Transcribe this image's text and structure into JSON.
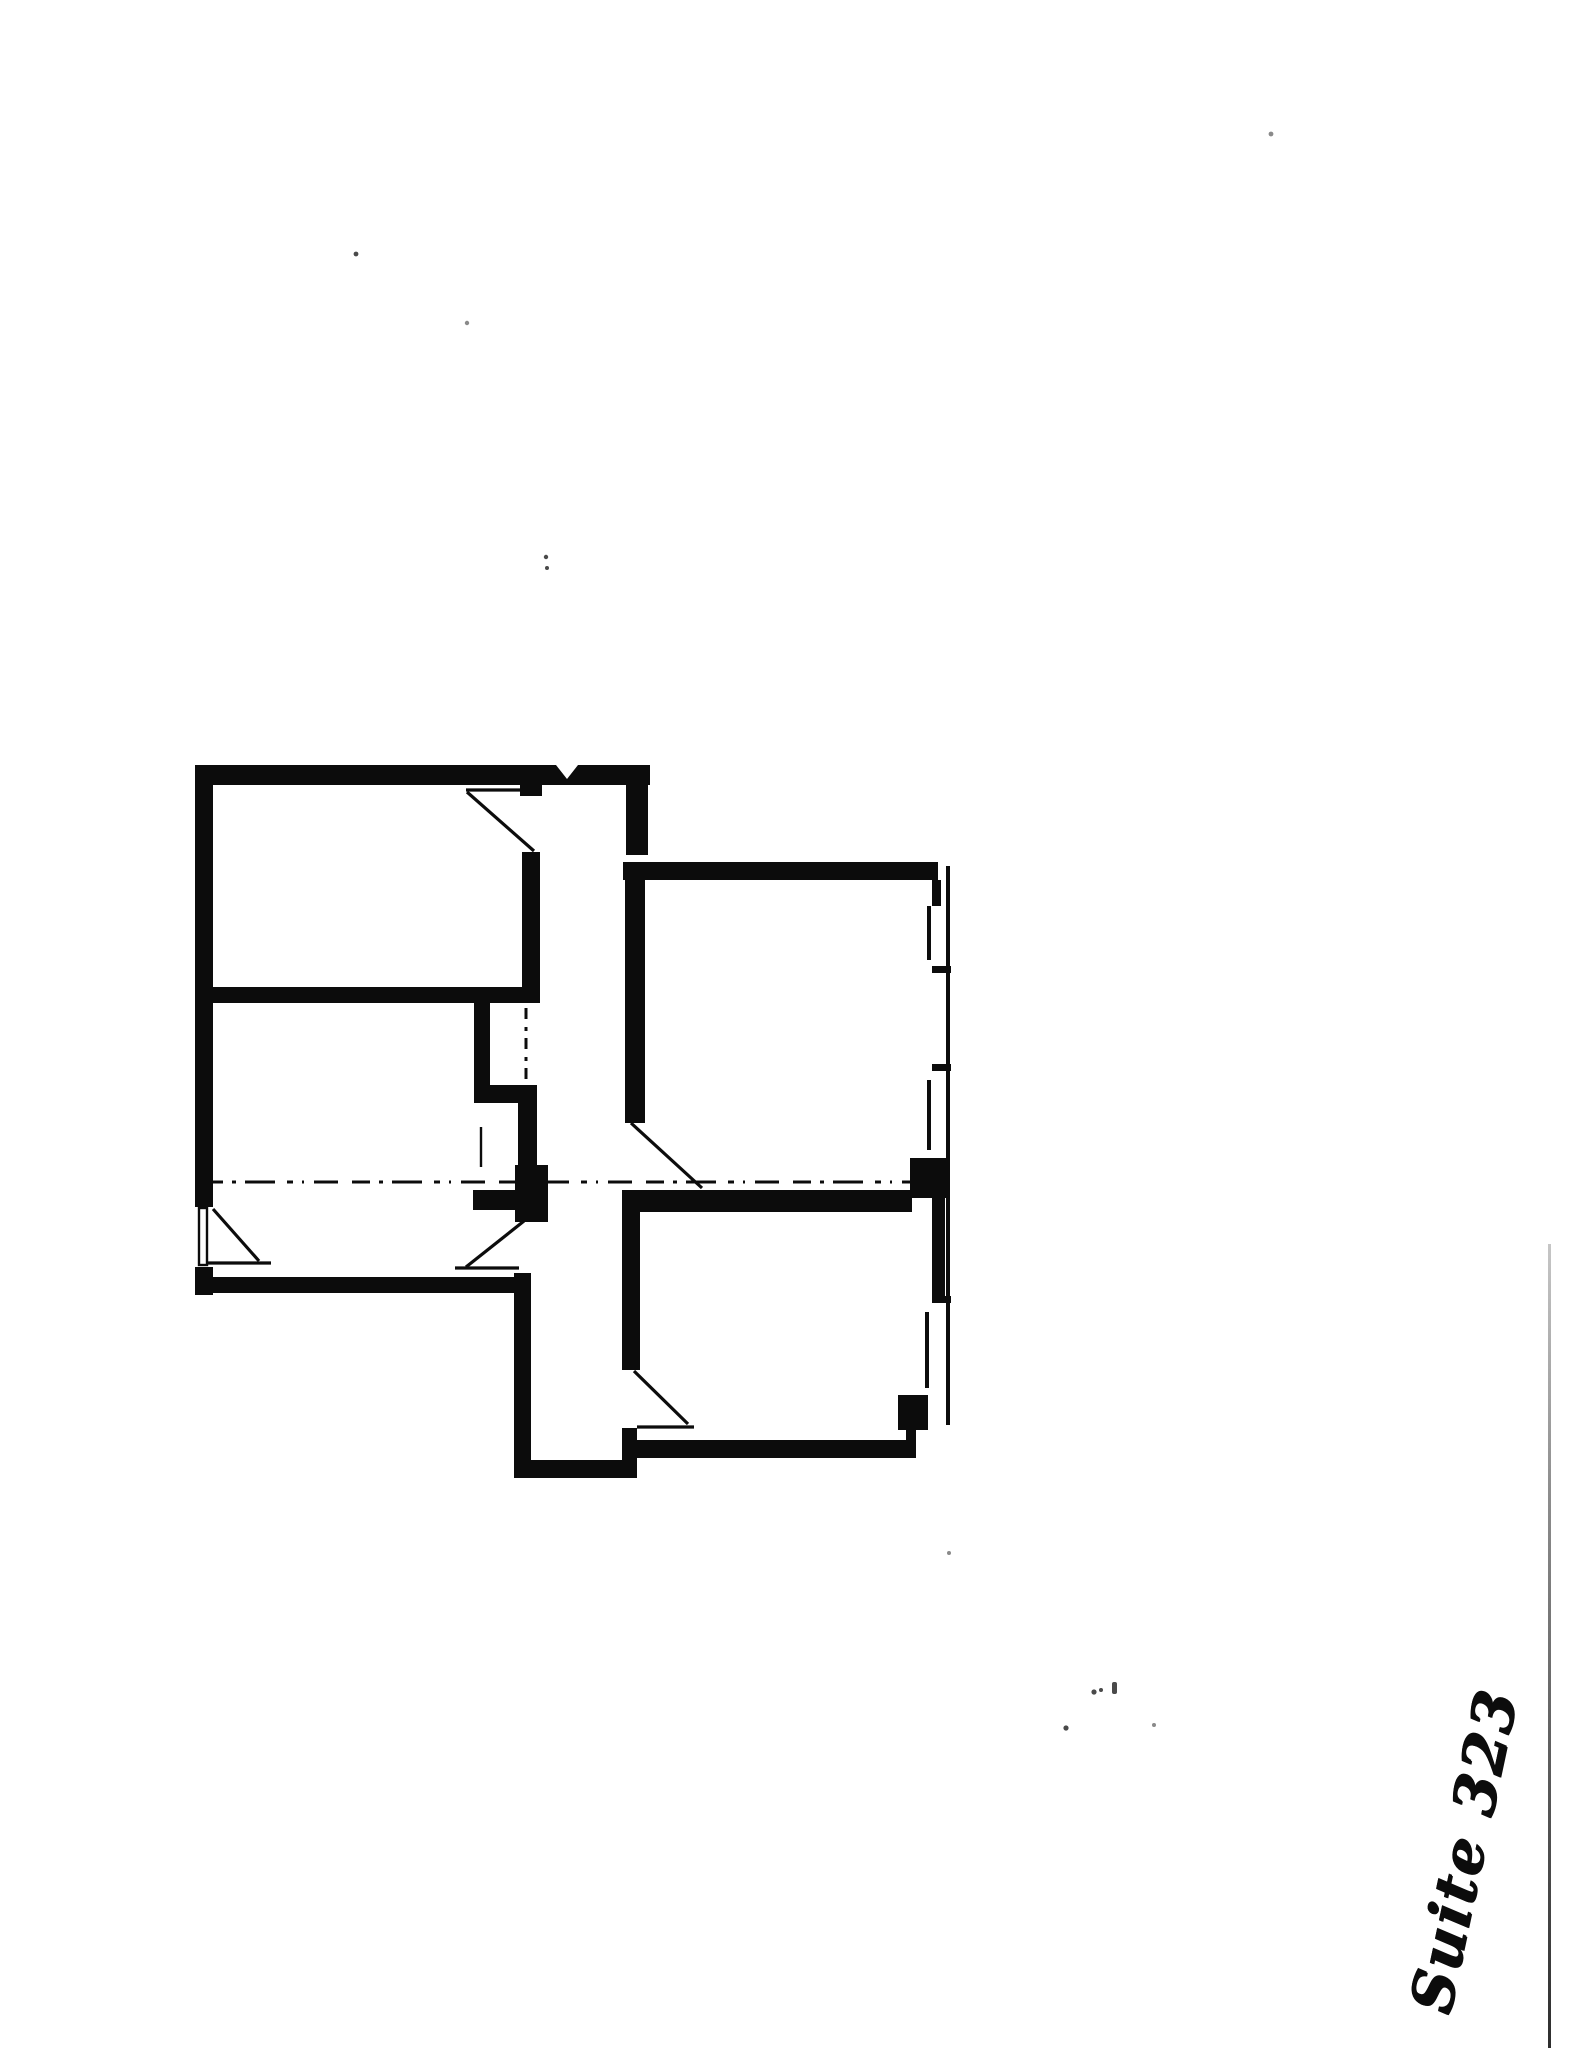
{
  "page": {
    "suite_label": "Suite 323"
  },
  "colors": {
    "ink": "#0c0c0c",
    "paper": "#ffffff",
    "scan_line_top": "#c6c6c6",
    "scan_line_bottom": "#2e2e2e"
  }
}
